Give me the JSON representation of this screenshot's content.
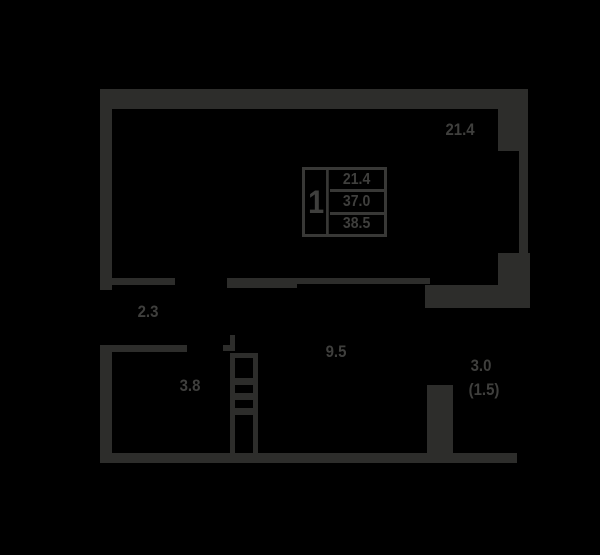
{
  "floorplan": {
    "legend": {
      "rooms_count": "1",
      "living_area": "21.4",
      "apartment_area": "37.0",
      "total_area": "38.5"
    },
    "labels": {
      "living_room": "21.4",
      "hallway": "2.3",
      "bathroom": "3.8",
      "kitchen": "9.5",
      "balcony": "3.0",
      "balcony_reduced": "(1.5)"
    },
    "colors": {
      "background": "#000000",
      "wall": "#2d2d2b",
      "label": "#3f3f3d",
      "legend_line": "#383836"
    }
  }
}
